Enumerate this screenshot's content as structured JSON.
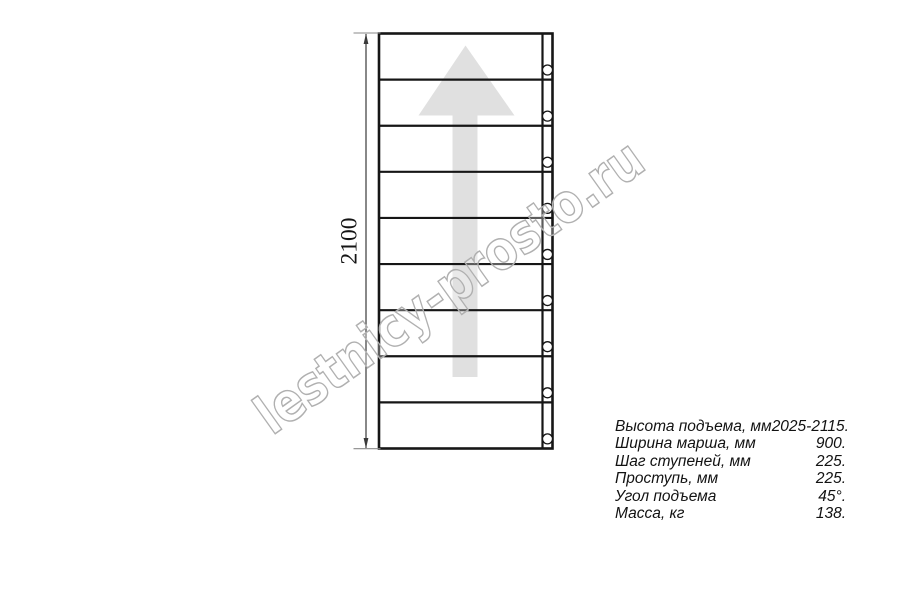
{
  "watermark": {
    "text": "lestnicy-prosto.ru",
    "outline_color": "#b0b0b0"
  },
  "drawing": {
    "dimension_label": "2100",
    "step_rows": 9,
    "hole_count": 9,
    "line_color": "#161616",
    "arrow_color": "#e0e0e0",
    "dim_line_color": "#3a3a3a",
    "ext_line_color": "#8a8a8a",
    "hole_fill": "#ffffff"
  },
  "specs": {
    "rows": [
      {
        "label": "Высота подъема, мм",
        "value": "2025-2115."
      },
      {
        "label": "Ширина марша, мм",
        "value": "900."
      },
      {
        "label": "Шаг ступеней, мм",
        "value": "225."
      },
      {
        "label": "Проступь, мм",
        "value": "225."
      },
      {
        "label": "Угол подъема",
        "value": "45°."
      },
      {
        "label": "Масса, кг",
        "value": "138."
      }
    ]
  }
}
